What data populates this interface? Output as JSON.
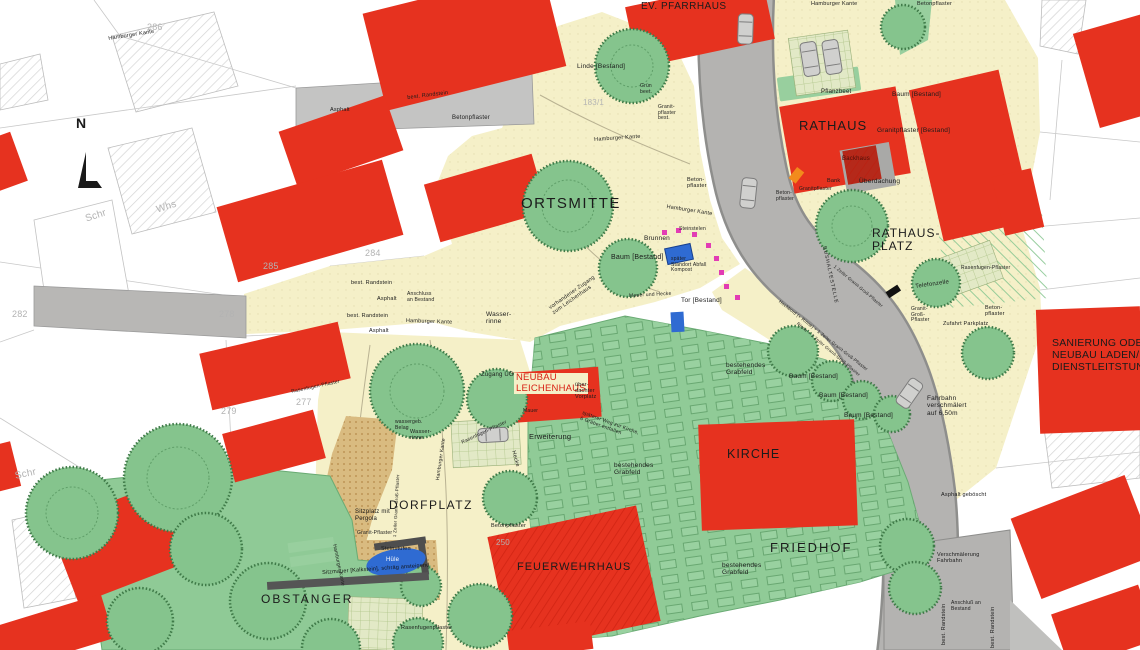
{
  "drawing": {
    "type": "site-plan",
    "colors": {
      "building_red": "#e6321f",
      "plaza_beige": "#f5f0c8",
      "road_gray": "#b4b3b1",
      "lawn_green": "#90cb97",
      "tree_green": "#85c48d",
      "water_blue": "#2f6bd2",
      "stele_pink": "#e23cb4",
      "accent_orange": "#f28b1c",
      "path_tan": "#d9bb80"
    }
  },
  "labels": [
    {
      "id": "label-ortsmitte",
      "t": "ORTSMITTE",
      "x": 521,
      "y": 196,
      "fs": 15,
      "ls": 1.5
    },
    {
      "id": "label-rathaus",
      "t": "RATHAUS",
      "x": 799,
      "y": 119,
      "fs": 13,
      "ls": 1
    },
    {
      "id": "label-rathausplatz",
      "t": "RATHAUS-\nPLATZ",
      "x": 872,
      "y": 227,
      "fs": 12,
      "ls": 1
    },
    {
      "id": "label-kirche",
      "t": "KIRCHE",
      "x": 727,
      "y": 447,
      "fs": 12.5,
      "ls": 1
    },
    {
      "id": "label-friedhof",
      "t": "FRIEDHOF",
      "x": 770,
      "y": 541,
      "fs": 13,
      "ls": 2
    },
    {
      "id": "label-feuerwehrhaus",
      "t": "FEUERWEHRHAUS",
      "x": 517,
      "y": 561,
      "fs": 11,
      "ls": 1
    },
    {
      "id": "label-dorfplatz",
      "t": "DORFPLATZ",
      "x": 389,
      "y": 499,
      "fs": 12,
      "ls": 1.5
    },
    {
      "id": "label-obstanger",
      "t": "OBSTANGER",
      "x": 261,
      "y": 593,
      "fs": 12,
      "ls": 2
    },
    {
      "id": "label-ev-pfarrhaus",
      "t": "EV. PFARRHAUS",
      "x": 641,
      "y": 1,
      "fs": 10,
      "ls": 0.5
    },
    {
      "id": "label-sanierung",
      "t": "SANIERUNG ODER\nNEUBAU LADEN/\nDIENSTLEITSTUNG",
      "x": 1052,
      "y": 338,
      "fs": 10.5
    },
    {
      "id": "label-neubau-leichenhaus",
      "t": "NEUBAU\nLEICHENHAUS",
      "x": 514,
      "y": 373,
      "fs": 9.5,
      "c": "#d81e12",
      "bg": "#f5f0c8"
    },
    {
      "id": "label-linde-bestand",
      "t": "Linde [Bestand]",
      "x": 577,
      "y": 63,
      "fs": 6.5
    },
    {
      "id": "label-gruenbeet",
      "t": "Grün\nbeet.",
      "x": 640,
      "y": 84,
      "fs": 5
    },
    {
      "id": "label-granitpflaster-best",
      "t": "Granit-\npflaster\nbest.",
      "x": 658,
      "y": 105,
      "fs": 5
    },
    {
      "id": "label-hamburger-kante-1",
      "t": "Hamburger Kante",
      "x": 108,
      "y": 36,
      "fs": 5.5,
      "rot": -9
    },
    {
      "id": "label-hamburger-kante-2",
      "t": "Hamburger Kante",
      "x": 594,
      "y": 137,
      "fs": 5.5,
      "rot": -4
    },
    {
      "id": "label-hamburger-kante-3",
      "t": "Hamburger Kante",
      "x": 667,
      "y": 204,
      "fs": 5.5,
      "rot": 9
    },
    {
      "id": "label-hamburger-kante-4",
      "t": "Hamburger Kante",
      "x": 406,
      "y": 318,
      "fs": 5.5,
      "rot": 2
    },
    {
      "id": "label-hamburger-kante-5",
      "t": "Hamburger Kante",
      "x": 811,
      "y": 1,
      "fs": 5.5
    },
    {
      "id": "label-hamburger-kante-6",
      "t": "Hamburger Kante",
      "x": 336,
      "y": 544,
      "fs": 5,
      "rot": 78
    },
    {
      "id": "label-hamburger-kante-7",
      "t": "Hamburger Kante",
      "x": 436,
      "y": 480,
      "fs": 5,
      "rot": -82
    },
    {
      "id": "label-betonpflaster-1",
      "t": "Betonpflaster",
      "x": 452,
      "y": 115,
      "fs": 6
    },
    {
      "id": "label-betonpflaster-2",
      "t": "Betonpflaster",
      "x": 917,
      "y": 1,
      "fs": 5.5
    },
    {
      "id": "label-betonpflaster-3",
      "t": "Beton-\npflaster",
      "x": 687,
      "y": 177,
      "fs": 5.5
    },
    {
      "id": "label-betonpflaster-4",
      "t": "Beton-\npflaster",
      "x": 776,
      "y": 191,
      "fs": 5
    },
    {
      "id": "label-betonpflaster-5",
      "t": "Betonpflaster",
      "x": 491,
      "y": 523,
      "fs": 5.5
    },
    {
      "id": "label-betonpflaster-6",
      "t": "Beton-\npflaster",
      "x": 985,
      "y": 305,
      "fs": 5.5
    },
    {
      "id": "label-randstein-1",
      "t": "best. Randstein",
      "x": 407,
      "y": 95,
      "fs": 5.5,
      "rot": -7
    },
    {
      "id": "label-randstein-2",
      "t": "best. Randstein",
      "x": 351,
      "y": 280,
      "fs": 5.5
    },
    {
      "id": "label-randstein-3",
      "t": "best. Randstein",
      "x": 347,
      "y": 313,
      "fs": 5.5
    },
    {
      "id": "label-randstein-4",
      "t": "best. Randstein",
      "x": 941,
      "y": 645,
      "fs": 5.5,
      "rot": -90
    },
    {
      "id": "label-randstein-5",
      "t": "best. Randstein",
      "x": 990,
      "y": 648,
      "fs": 5.5,
      "rot": -90
    },
    {
      "id": "label-asphalt-1",
      "t": "Asphalt",
      "x": 377,
      "y": 296,
      "fs": 5.5
    },
    {
      "id": "label-asphalt-2",
      "t": "Asphalt",
      "x": 369,
      "y": 328,
      "fs": 5.5
    },
    {
      "id": "label-asphalt-3",
      "t": "Asphalt",
      "x": 330,
      "y": 107,
      "fs": 5.5
    },
    {
      "id": "label-anschluss-1",
      "t": "Anschluss\nan Bestand",
      "x": 407,
      "y": 292,
      "fs": 5
    },
    {
      "id": "label-wasserrinne-1",
      "t": "Wasser-\nrinne",
      "x": 486,
      "y": 311,
      "fs": 6.5
    },
    {
      "id": "label-brunnen",
      "t": "Brunnen",
      "x": 644,
      "y": 235,
      "fs": 6.5
    },
    {
      "id": "label-baum-bestand-1",
      "t": "Baum [Bestand]",
      "x": 611,
      "y": 254,
      "fs": 7
    },
    {
      "id": "label-baum-bestand-2",
      "t": "Baum [Bestand]",
      "x": 892,
      "y": 91,
      "fs": 6.5
    },
    {
      "id": "label-baum-bestand-3",
      "t": "Baum [Bestand]",
      "x": 789,
      "y": 373,
      "fs": 6.5
    },
    {
      "id": "label-baum-bestand-4",
      "t": "Baum [Bestand]",
      "x": 819,
      "y": 392,
      "fs": 6.5
    },
    {
      "id": "label-baum-bestand-5",
      "t": "Baum [Bestand]",
      "x": 844,
      "y": 412,
      "fs": 6.5
    },
    {
      "id": "label-grabfeld-1",
      "t": "bestehendes\nGrabfeld",
      "x": 726,
      "y": 362,
      "fs": 6.5
    },
    {
      "id": "label-grabfeld-2",
      "t": "bestehendes\nGrabfeld",
      "x": 614,
      "y": 462,
      "fs": 6.5
    },
    {
      "id": "label-grabfeld-3",
      "t": "bestehendes\nGrabfeld",
      "x": 722,
      "y": 562,
      "fs": 6.5
    },
    {
      "id": "label-erweiterung",
      "t": "Erweiterung",
      "x": 529,
      "y": 433,
      "fs": 7.5
    },
    {
      "id": "label-hecke",
      "t": "Hecke",
      "x": 516,
      "y": 450,
      "fs": 5.5,
      "rot": 75
    },
    {
      "id": "label-zugang-ug",
      "t": "Zugang UG",
      "x": 481,
      "y": 372,
      "fs": 6
    },
    {
      "id": "label-vorplatz",
      "t": "über-\ndachter\nVorplatz",
      "x": 575,
      "y": 382,
      "fs": 5.5
    },
    {
      "id": "label-weg-kirche",
      "t": "späterer Weg zur Kirche,\n6 Gräber entfallen",
      "x": 583,
      "y": 411,
      "fs": 5,
      "rot": 20
    },
    {
      "id": "label-mauer",
      "t": "Mauer",
      "x": 523,
      "y": 409,
      "fs": 5
    },
    {
      "id": "label-mauer-hecke",
      "t": "Mauer und Hecke",
      "x": 629,
      "y": 294,
      "fs": 5,
      "rot": -3
    },
    {
      "id": "label-tor-bestand",
      "t": "Tor [Bestand]",
      "x": 681,
      "y": 297,
      "fs": 6.5
    },
    {
      "id": "label-abfall",
      "t": "später\nStandort Abfall\nKompost",
      "x": 671,
      "y": 257,
      "fs": 5
    },
    {
      "id": "label-steinstelen",
      "t": "Steinstelen",
      "x": 679,
      "y": 227,
      "fs": 5
    },
    {
      "id": "label-pflanzbeet",
      "t": "Pflanzbeet",
      "x": 821,
      "y": 89,
      "fs": 6
    },
    {
      "id": "label-granitpflaster-bestand",
      "t": "Granitpflaster [Bestand]",
      "x": 877,
      "y": 127,
      "fs": 6.5
    },
    {
      "id": "label-backhaus",
      "t": "Backhaus",
      "x": 842,
      "y": 156,
      "fs": 6,
      "c": "#4a0e07"
    },
    {
      "id": "label-bank",
      "t": "Bank",
      "x": 827,
      "y": 178,
      "fs": 5.5
    },
    {
      "id": "label-ueberdachung",
      "t": "Überdachung",
      "x": 859,
      "y": 178,
      "fs": 6.5
    },
    {
      "id": "label-granitpflaster-2",
      "t": "Granitpflaster",
      "x": 799,
      "y": 187,
      "fs": 5
    },
    {
      "id": "label-telefonzelle",
      "t": "Telefonzelle",
      "x": 915,
      "y": 284,
      "fs": 6,
      "rot": -8
    },
    {
      "id": "label-rasenfugen-1",
      "t": "Rasenfugen-Pflaster",
      "x": 961,
      "y": 266,
      "fs": 5
    },
    {
      "id": "label-granit-gross",
      "t": "Granit-\nGroß-\nPflaster",
      "x": 911,
      "y": 307,
      "fs": 5
    },
    {
      "id": "label-zufahrt-parkplatz",
      "t": "Zufahrt Parkplatz",
      "x": 943,
      "y": 321,
      "fs": 5.5
    },
    {
      "id": "label-fahrbahn",
      "t": "Fahrbahn\nverschmälert\nauf 6,50m",
      "x": 927,
      "y": 395,
      "fs": 6.5
    },
    {
      "id": "label-asphalt-geboescht",
      "t": "Asphalt geböscht",
      "x": 941,
      "y": 492,
      "fs": 5.5
    },
    {
      "id": "label-verschmaelerung",
      "t": "Verschmälerung\nFahrbahn",
      "x": 937,
      "y": 552,
      "fs": 5.5
    },
    {
      "id": "label-anschluss-2",
      "t": "Anschluß an\nBestand",
      "x": 951,
      "y": 601,
      "fs": 5
    },
    {
      "id": "label-hochbord",
      "t": "Hochbord (+ Rinne) + 1 Zeiler Granit-Groß-Pflaster",
      "x": 781,
      "y": 299,
      "fs": 4.5,
      "rot": 38
    },
    {
      "id": "label-zeiler-1",
      "t": "1 Zeiler Granit-Groß-Pflaster",
      "x": 836,
      "y": 264,
      "fs": 4.5,
      "rot": 40
    },
    {
      "id": "label-zeiler-2",
      "t": "Rinne + 1 Zeiler Granit-Groß-Pflaster",
      "x": 799,
      "y": 321,
      "fs": 4.5,
      "rot": 40
    },
    {
      "id": "label-bushaltestelle",
      "t": "BUSHALTESTELLE",
      "x": 826,
      "y": 246,
      "fs": 5,
      "rot": 78,
      "ls": 1
    },
    {
      "id": "label-wassergeb",
      "t": "wassergeb.\nBelag",
      "x": 395,
      "y": 420,
      "fs": 5
    },
    {
      "id": "label-wasserrinne-2",
      "t": "Wasser-\nrinne",
      "x": 410,
      "y": 429,
      "fs": 5.5
    },
    {
      "id": "label-sitzplatz",
      "t": "Sitzplatz mit\nPergola",
      "x": 355,
      "y": 509,
      "fs": 6
    },
    {
      "id": "label-granit-pflaster-3",
      "t": "Granit-Pflaster",
      "x": 357,
      "y": 531,
      "fs": 5
    },
    {
      "id": "label-steinstufen",
      "t": "Steinstufen",
      "x": 381,
      "y": 546,
      "fs": 5.5
    },
    {
      "id": "label-huele",
      "t": "Hüle",
      "x": 386,
      "y": 557,
      "fs": 6,
      "c": "#ffffff"
    },
    {
      "id": "label-sitzmauer",
      "t": "Sitzmauer [Kalkstein], schräg ansteigend",
      "x": 322,
      "y": 570,
      "fs": 5.5,
      "rot": -4,
      "c": "#111111"
    },
    {
      "id": "label-zeiler-3",
      "t": "1 Zeiler Granit-Groß-Pflaster",
      "x": 392,
      "y": 537,
      "fs": 4.5,
      "rot": -87
    },
    {
      "id": "label-rasenfugen-2",
      "t": "Rasenfugen-Pflaster",
      "x": 461,
      "y": 441,
      "fs": 5,
      "rot": -25
    },
    {
      "id": "label-rasenfugen-3",
      "t": "Rasenfugenpflaster",
      "x": 401,
      "y": 625,
      "fs": 5.5
    },
    {
      "id": "label-rasenfugen-4",
      "t": "Rasenfugen-Pflaster",
      "x": 291,
      "y": 390,
      "fs": 5,
      "rot": -12
    },
    {
      "id": "label-vorh-zugang",
      "t": "vorhandener Zugang\nzum Leichenhaus",
      "x": 548,
      "y": 306,
      "fs": 5.5,
      "rot": -35
    },
    {
      "id": "label-north",
      "t": "N",
      "x": 76,
      "y": 116,
      "fs": 14,
      "w": 700
    },
    {
      "id": "parcel-286",
      "t": "286",
      "x": 147,
      "y": 22,
      "fs": 9,
      "cls": "gray"
    },
    {
      "id": "parcel-285",
      "t": "285",
      "x": 263,
      "y": 261,
      "fs": 9,
      "cls": "gray"
    },
    {
      "id": "parcel-284",
      "t": "284",
      "x": 365,
      "y": 248,
      "fs": 9,
      "cls": "gray"
    },
    {
      "id": "parcel-278",
      "t": "278",
      "x": 219,
      "y": 309,
      "fs": 9,
      "cls": "gray"
    },
    {
      "id": "parcel-277",
      "t": "277",
      "x": 296,
      "y": 397,
      "fs": 9,
      "cls": "gray"
    },
    {
      "id": "parcel-279",
      "t": "279",
      "x": 221,
      "y": 406,
      "fs": 9,
      "cls": "gray"
    },
    {
      "id": "parcel-282",
      "t": "282",
      "x": 12,
      "y": 309,
      "fs": 9,
      "cls": "gray"
    },
    {
      "id": "parcel-183-1",
      "t": "183/1",
      "x": 583,
      "y": 99,
      "fs": 8,
      "cls": "gray"
    },
    {
      "id": "parcel-250",
      "t": "250",
      "x": 496,
      "y": 539,
      "fs": 8,
      "cls": "gray"
    },
    {
      "id": "cadastre-schr-1",
      "t": "Schr",
      "x": 84,
      "y": 214,
      "fs": 10,
      "rot": -18,
      "cls": "gray"
    },
    {
      "id": "cadastre-whs-1",
      "t": "Whs",
      "x": 155,
      "y": 205,
      "fs": 10,
      "rot": -18,
      "cls": "gray"
    },
    {
      "id": "cadastre-schr-2",
      "t": "Schr",
      "x": 14,
      "y": 471,
      "fs": 10,
      "rot": -12,
      "cls": "gray"
    }
  ]
}
